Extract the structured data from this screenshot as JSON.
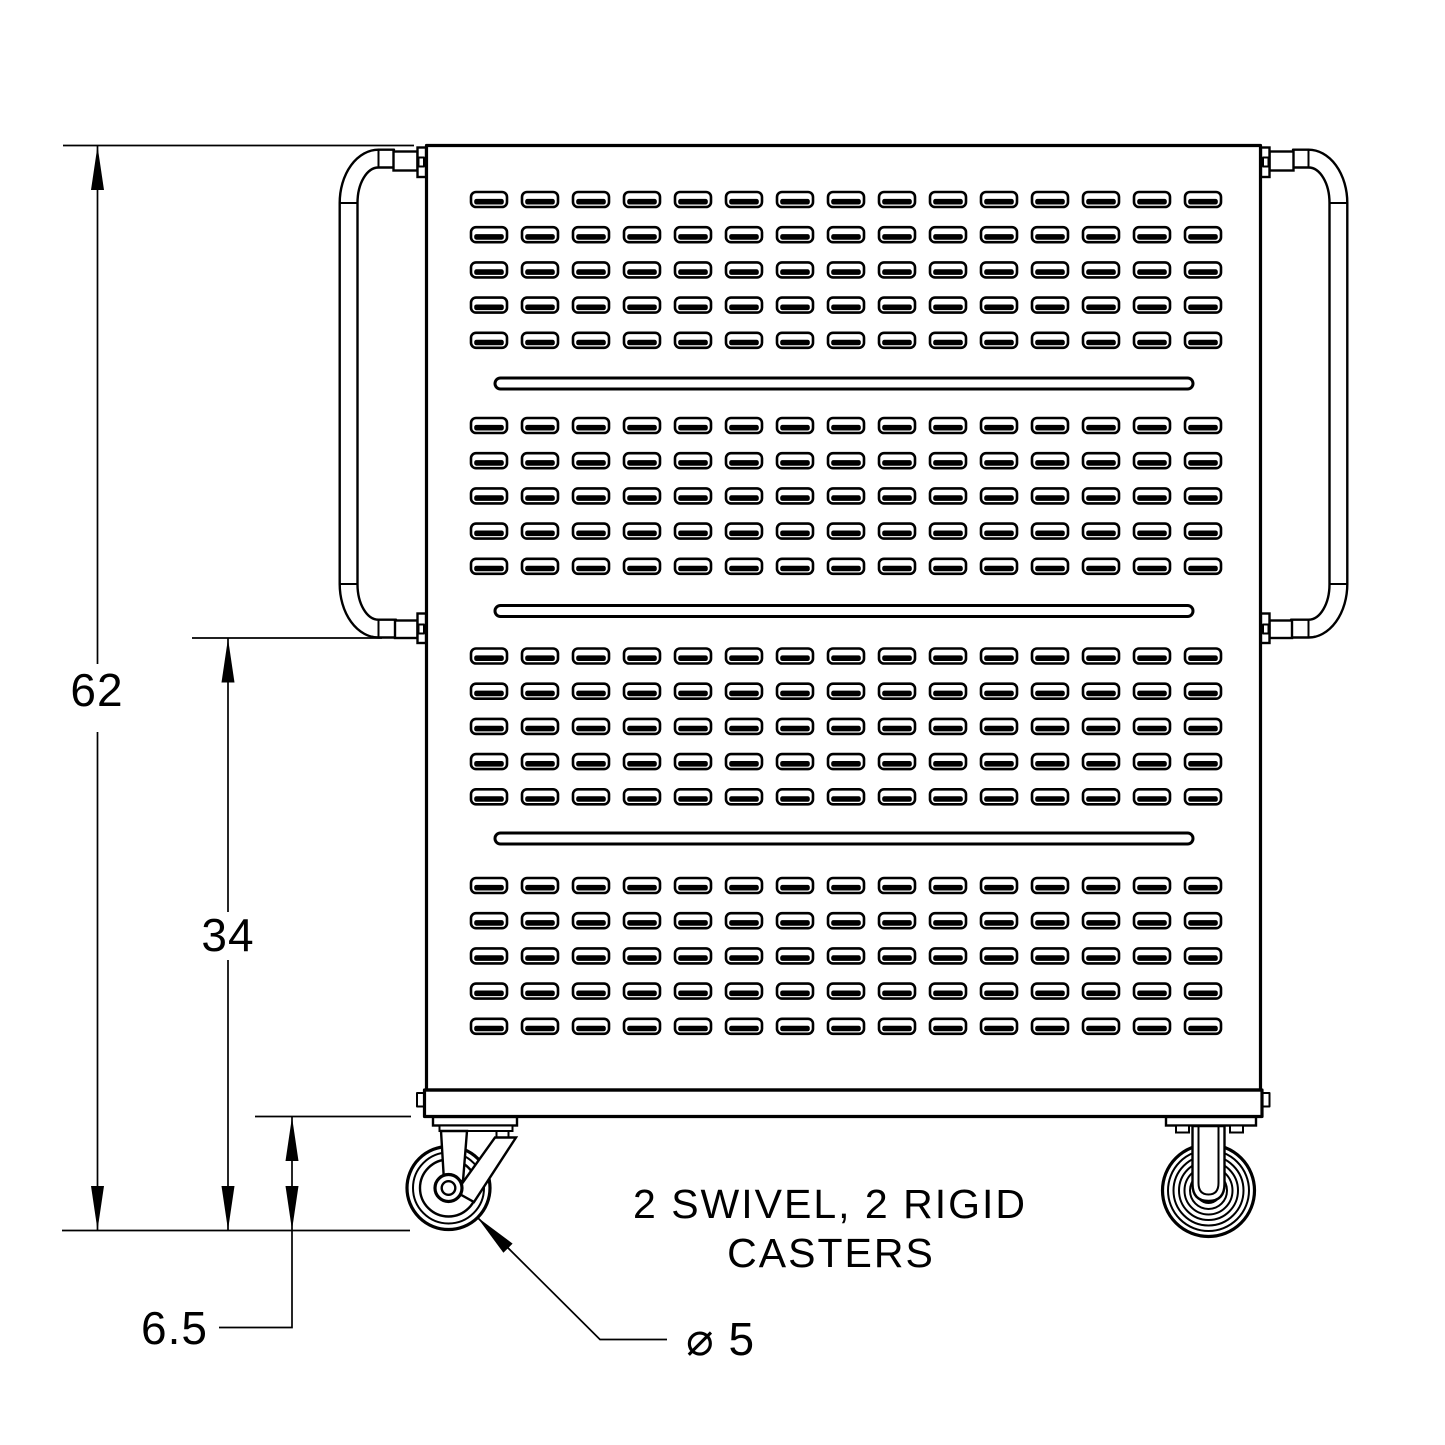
{
  "dimensions": {
    "overall_height": "62",
    "handle_bottom_to_floor": "34",
    "caster_height": "6.5",
    "wheel_diameter": "⌀ 5"
  },
  "note": {
    "line1": "2 SWIVEL, 2 RIGID",
    "line2": "CASTERS"
  },
  "pattern": {
    "louver_bands": 4,
    "rows_per_band": 5,
    "columns": 15,
    "groove_count": 3
  },
  "colors": {
    "line": "#000000",
    "background": "#ffffff"
  }
}
